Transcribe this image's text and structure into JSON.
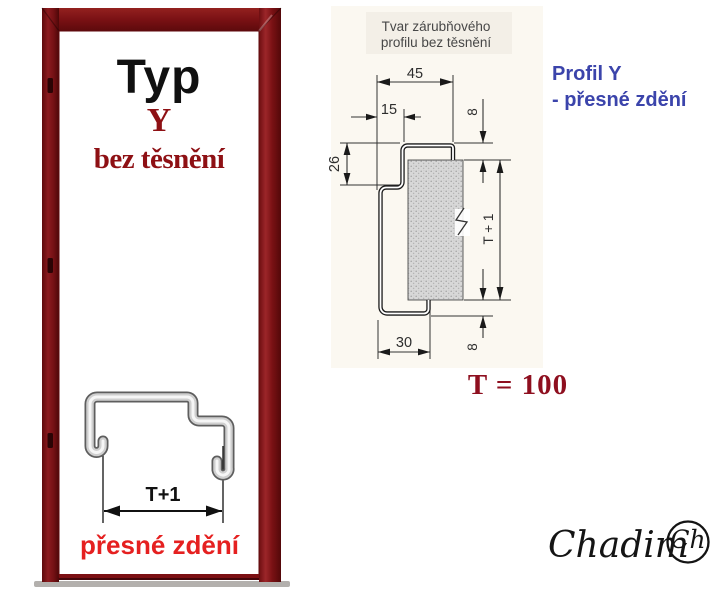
{
  "door": {
    "title": "Typ",
    "variant": "Y",
    "seal_note": "bez těsnění",
    "sketch": {
      "dimension": "T+1",
      "caption": "přesné zdění"
    }
  },
  "drawing": {
    "title_line1": "Tvar zárubňového",
    "title_line2": "profilu bez těsnění",
    "dimensions": {
      "top_width": "45",
      "step_offset": "15",
      "step_height": "26",
      "top_overhang": "8",
      "wall_height": "T + 1",
      "bottom_width": "30",
      "bottom_overhang": "8"
    },
    "note_line1": "Profil Y",
    "note_line2": "- přesné zdění",
    "formula": "T = 100"
  },
  "logo": {
    "wordmark": "Chadim",
    "monogram": "Ch"
  },
  "colors": {
    "frame_maroon": "#7a1114",
    "dark_red_text": "#8e0f1a",
    "bright_red_text": "#e52020",
    "note_blue": "#3b44ab",
    "drawing_line": "#333333"
  }
}
